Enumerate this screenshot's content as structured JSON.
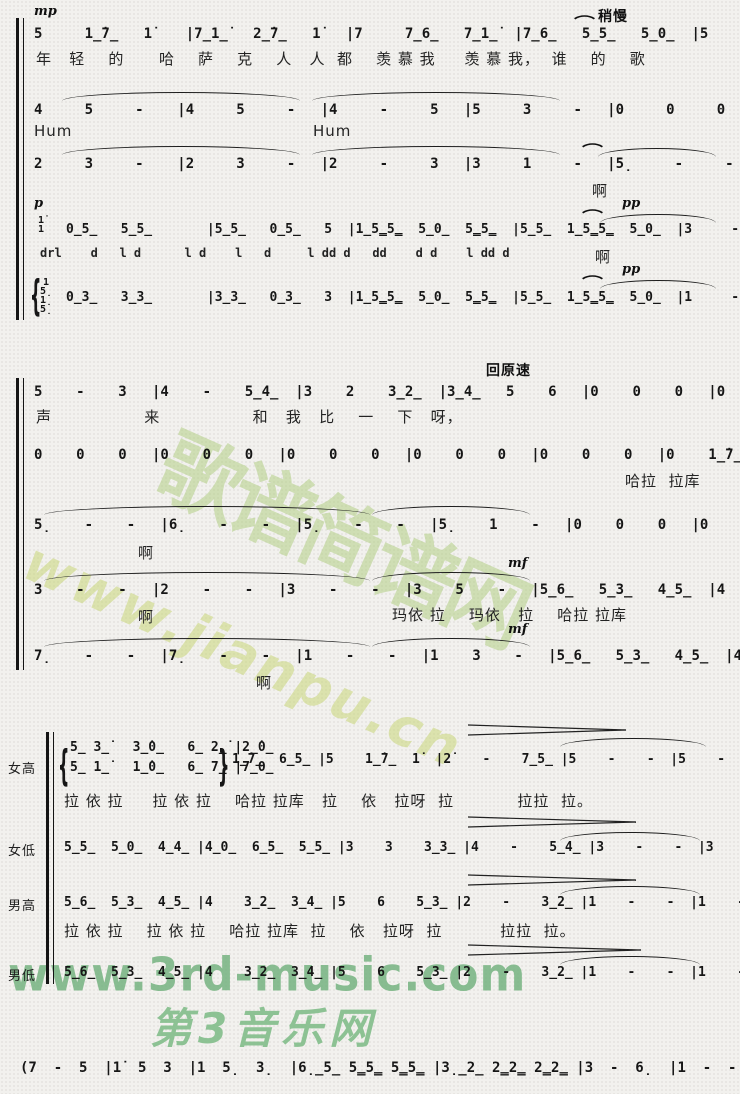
{
  "marks": {
    "mp": "mp",
    "p": "p",
    "pp": "pp",
    "mf": "mf",
    "slower": "稍慢",
    "tempo_back": "回原速",
    "fermata": "⌒",
    "ah": "啊",
    "hum": "Hum",
    "brace_open": "{",
    "brace_close": "}"
  },
  "system1": {
    "line1": {
      "notes": "5     1̲̇7̲   1̇    |7̲1̲̇   2̲̇7̲   1̇   |7     7̲6̲   7̲1̲̇  |7̲6̲   5̲5̲   5̲0̲  |5     6     6̲5̲  |",
      "lyrics": "年   轻    的      哈    萨    克    人   人  都    羡 慕 我     羡 慕 我，  谁    的    歌"
    },
    "line2": {
      "notes": "4     5     -    |4     5     -   |4     -     5   |5     3     -   |0     0     0   |"
    },
    "line3": {
      "notes": "2     3     -    |2     3     -   |2     -     3   |3     1     -   |5̣     -     -   |"
    },
    "line4": {
      "chord": [
        "1̇",
        "1"
      ],
      "notes": "0̲5̲   5̲5̲       |5̲5̲   0̲5̲   5  |1̲5̳5̳  5̲0̲  5̳5̳  |5̲5̲  1̲5̳5̳  5̲0̲  |3     -     -   |",
      "syllables": "drl    d   l d      l d    l   d     l dd d   dd    d d    l dd d"
    },
    "line5": {
      "chord": [
        "1",
        "5̣",
        "1̣",
        "5̣"
      ],
      "notes": "0̲3̲   3̲3̲       |3̲3̲   0̲3̲   3  |1̲5̳5̳  5̲0̲  5̳5̳  |5̲5̲  1̲5̳5̳  5̲0̲  |1     -     -   |"
    }
  },
  "system2": {
    "line1": {
      "notes": "5    -    3   |4    -    5̲4̲  |3    2    3̲2̲  |3̲4̲   5    6   |0    0    0   |0    0    0   |",
      "lyrics": "声                来                和   我   比    一    下   呀，"
    },
    "line2": {
      "notes": "0    0    0   |0    0    0   |0    0    0   |0    0    0   |0    0    0   |0    1̲̇7̲   6̲5̲  |",
      "lyrics": "哈拉  拉库"
    },
    "line3": {
      "notes": "5̣    -    -   |6̣    -    -   |5̣    -    -   |5̣    1    -   |0    0    0   |0    6̲5̲   5̲5̲  |"
    },
    "line4": {
      "notes": "3    -    -   |2    -    -   |3    -    -   |3    5    -   |5̲6̲   5̲3̲   4̲5̲  |4    3̲2̲   3̲4̲  |",
      "lyrics": "玛依 拉    玛依   拉    哈拉 拉库"
    },
    "line5": {
      "notes": "7̣    -    -   |7̣    -    -   |1    -    -   |1    3    -   |5̲6̲   5̲3̲   4̲5̲  |4    3̲2̲   3̲4̲  |"
    }
  },
  "system3": {
    "soprano": {
      "label": "女高",
      "upper": "5̲ 3̲̇   3̲̇0̲   6̲ 2̲̇ |2̲̇0̲",
      "lower": "5̲ 1̲̇   1̲̇0̲   6̲ 7̲ |7̲0̲",
      "cont": "1̲̇7̲  6̲5̲ |5    1̲̇7̲  1̇  |2̇    -    7̲5̲ |5    -    -  |5    -    -  |",
      "lyrics": "拉 依 拉     拉 依 拉    哈拉 拉库   拉    依   拉呀  拉           拉拉  拉。"
    },
    "alto": {
      "label": "女低",
      "notes": "5̲5̲  5̲0̲  4̲4̲ |4̲0̲  6̲5̲  5̲5̲ |3    3    3̲3̲ |4    -    5̲4̲ |3    -    -  |3    -    -  |"
    },
    "tenor": {
      "label": "男高",
      "notes": "5̲6̲  5̲3̲  4̲5̲ |4    3̲2̲  3̲4̲ |5    6    5̲3̲ |2    -    3̲2̲ |1    -    -  |1    -    -  |",
      "lyrics": "拉 依 拉    拉 依 拉    哈拉 拉库  拉    依   拉呀  拉          拉拉  拉。"
    },
    "bass": {
      "label": "男低",
      "notes": "5̲6̲  5̲3̲  4̲5̲ |4    3̲2̲  3̲4̲ |5    6    5̲3̲ |2    -    3̲2̲ |1    -    -  |1    -    -  |"
    }
  },
  "coda": {
    "notes": "(7  -  5  |1̇  5  3  |1  5̣  3̣  |6̣̲5̲ 5̳5̳ 5̳5̳ |3̣̲2̲ 2̳2̳ 2̳2̳ |3  -  6̣  |1  -  -  )|"
  },
  "watermarks": {
    "center_cn": "歌谱简谱网",
    "center_url": "www.jianpu.cn",
    "bottom_url": "www.3rd-music.com",
    "bottom_logo": "第3音乐网"
  }
}
